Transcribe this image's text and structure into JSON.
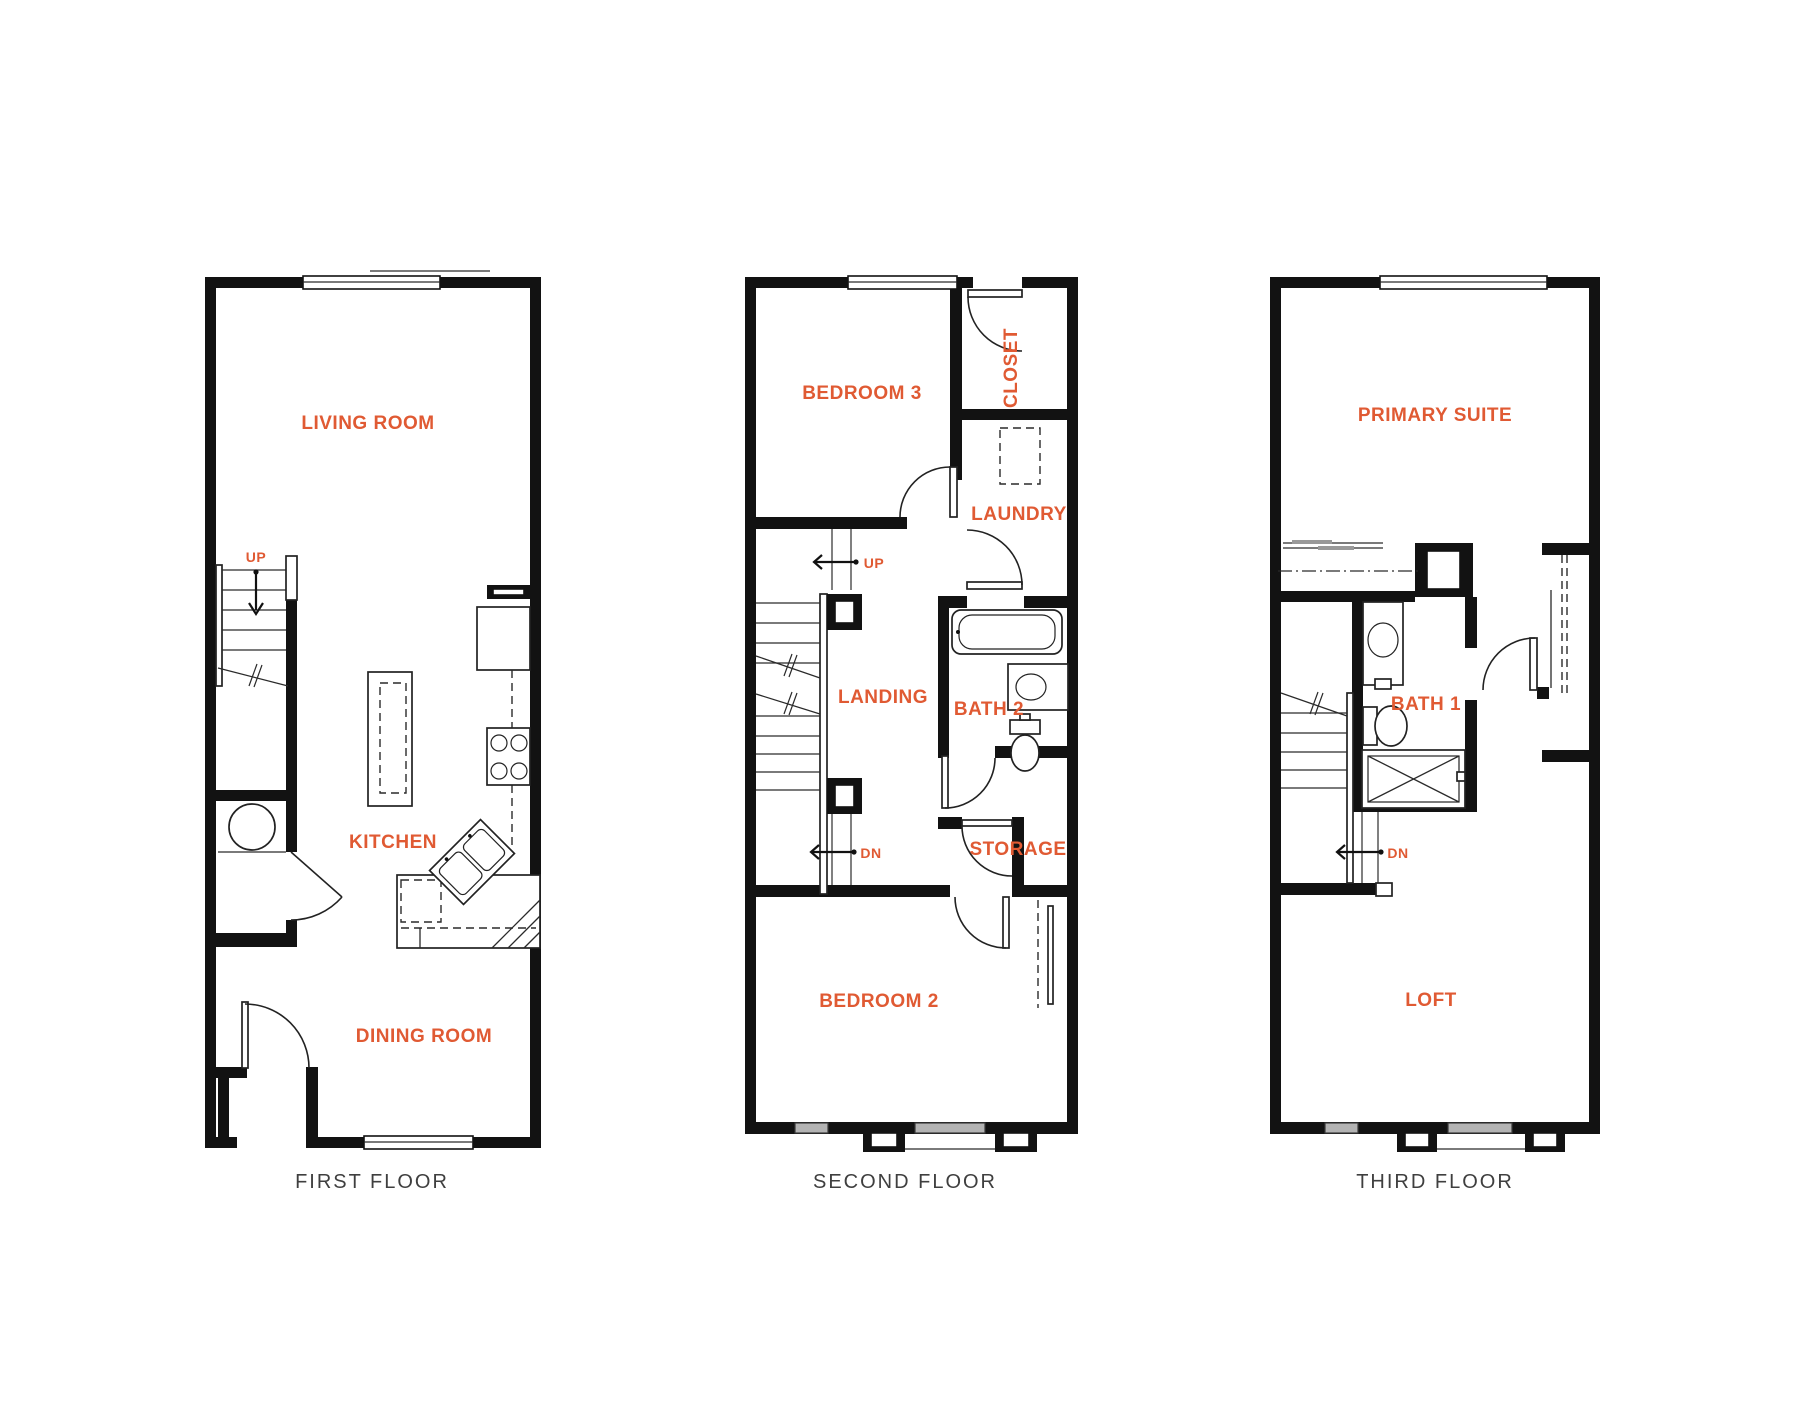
{
  "colors": {
    "room_label": "#e05a33",
    "caption": "#3f3f3f",
    "wall": "#121212",
    "thin_line": "#2a2a2a",
    "window_gray": "#b3b3b3",
    "background": "#ffffff"
  },
  "floor1": {
    "caption": "FIRST FLOOR",
    "living_room": "LIVING ROOM",
    "kitchen": "KITCHEN",
    "dining_room": "DINING ROOM",
    "up": "UP"
  },
  "floor2": {
    "caption": "SECOND FLOOR",
    "bedroom3": "BEDROOM 3",
    "closet": "CLOSET",
    "laundry": "LAUNDRY",
    "up": "UP",
    "landing": "LANDING",
    "bath2": "BATH 2",
    "dn": "DN",
    "storage": "STORAGE",
    "bedroom2": "BEDROOM 2"
  },
  "floor3": {
    "caption": "THIRD FLOOR",
    "primary_suite": "PRIMARY SUITE",
    "bath1": "BATH 1",
    "dn": "DN",
    "loft": "LOFT"
  }
}
